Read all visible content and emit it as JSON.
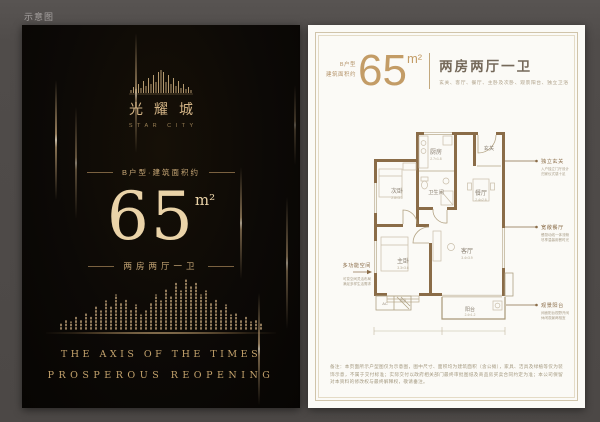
{
  "page": {
    "watermark": "示意图"
  },
  "left_panel": {
    "logo": {
      "name": "光耀城",
      "subtitle": "STAR CITY"
    },
    "area_intro": "B户型·建筑面积约",
    "area_value": "65",
    "area_unit": "m²",
    "rooms_line": "两房两厅一卫",
    "slogan_line1": "THE AXIS OF THE TIMES",
    "slogan_line2": "PROSPEROUS REOPENING"
  },
  "right_panel": {
    "header": {
      "type_line1": "B户型",
      "type_line2": "建筑面积约",
      "area_value": "65",
      "area_unit": "m²",
      "rooms_title": "两房两厅一卫",
      "rooms_detail": "玄关、客厅、餐厅、主卧及次卧、观景阳台、独立卫浴"
    },
    "floorplan": {
      "rooms": {
        "kitchen": {
          "label": "厨房",
          "dim": "2.7×1.8"
        },
        "bath": {
          "label": "卫生间"
        },
        "entry": {
          "label": "玄关"
        },
        "dining": {
          "label": "餐厅",
          "dim": "2.4×2.6"
        },
        "bedroom2": {
          "label": "次卧",
          "dim": "2.8×3.0"
        },
        "master": {
          "label": "主卧",
          "dim": "3.3×3.6"
        },
        "living": {
          "label": "客厅",
          "dim": "3.4×3.9"
        },
        "balcony": {
          "label": "阳台",
          "dim": "2.4×1.2"
        },
        "bay_window": {
          "label": "飘窗"
        },
        "ac": {
          "label": "AC"
        }
      }
    },
    "callouts": {
      "right": [
        {
          "title": "独立玄关",
          "desc1": "入户独立门厅设计",
          "desc2": "归家仪式感十足"
        },
        {
          "title": "宽敞餐厅",
          "desc1": "餐厨动线一体流畅",
          "desc2": "尽享温馨用餐时光"
        },
        {
          "title": "观景阳台",
          "desc1": "阔面阳台视野开阔",
          "desc2": "休闲观景两相宜"
        }
      ],
      "left": {
        "title": "多功能空间",
        "desc1": "可变空间灵活布局",
        "desc2": "满足多样生活需求"
      }
    },
    "disclaimer": "备注：本页面所示户型图仅为示意图，图中尺寸、面积均为建筑面积（含公摊），家具、洁具及绿植等仅为装饰示意，不属于交付标准；实际交付以政府相关部门最终审批图纸及商品房买卖合同约定为准；本公司保留对本资料的修改权与最终解释权，敬请垂注。"
  },
  "colors": {
    "accent_gold": "#c9a76f",
    "wall_brown": "#8a6c48",
    "panel_black": "#0b0807",
    "paper_white": "#fbfaf6"
  }
}
